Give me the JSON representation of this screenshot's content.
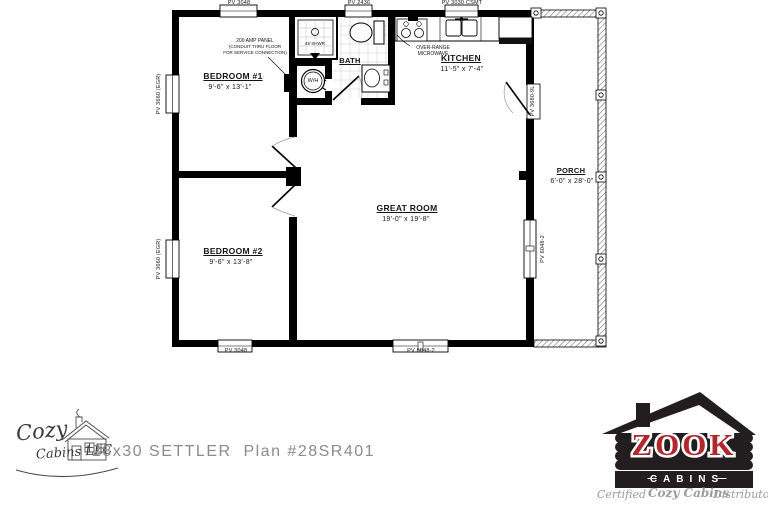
{
  "plan": {
    "rooms": {
      "bedroom1": {
        "name": "BEDROOM #1",
        "dims": "9'-6\" x 13'-1\""
      },
      "bedroom2": {
        "name": "BEDROOM #2",
        "dims": "9'-6\" x 13'-8\""
      },
      "bath": {
        "name": "BATH"
      },
      "kitchen": {
        "name": "KITCHEN",
        "dims": "11'-5\" x 7'-4\""
      },
      "great_room": {
        "name": "GREAT ROOM",
        "dims": "19'-0\" x 19'-8\""
      },
      "porch": {
        "name": "PORCH",
        "dims": "6'-0\" x 28'-0\""
      }
    },
    "openings": {
      "win_top_bedroom1": "PV 3048",
      "win_top_bath": "PV 2436",
      "win_top_kitchen": "PV 3030 CSMT",
      "win_left_bedroom1": "PV 3660 (EGR)",
      "win_left_bedroom2": "PV 3660 (EGR)",
      "win_bottom_bedroom2": "PV 3048",
      "win_bottom_great_room": "PV 6048-2",
      "win_east_great_room": "PV 6048-2",
      "door_porch": "PV 3680-9L"
    },
    "annotations": {
      "amp_panel": [
        "200 AMP PANEL",
        "(CONDUIT THRU FLOOR",
        "FOR SERVICE CONNECTION)"
      ],
      "microwave": [
        "OVER-RANGE",
        "MICROWAVE"
      ],
      "shower": "48 SHWR",
      "water_heater": "W/H"
    }
  },
  "footer": {
    "plan_title": "28x30 SETTLER  Plan #28SR401",
    "cozy_logo": {
      "line1": "Cozy",
      "line2": "Cabins LLC"
    },
    "zook_logo": {
      "name": "ZOOK",
      "sub": "CABINS",
      "dash": "—",
      "tagline_pre": "Certified",
      "tagline_brand": "Cozy Cabins",
      "tagline_post": "Distributor"
    }
  },
  "colors": {
    "zook_red": "#b0272e",
    "zook_black": "#221e1f",
    "tagline_gray": "#9b9b9b",
    "plan_title_gray": "#8b8b8b"
  }
}
